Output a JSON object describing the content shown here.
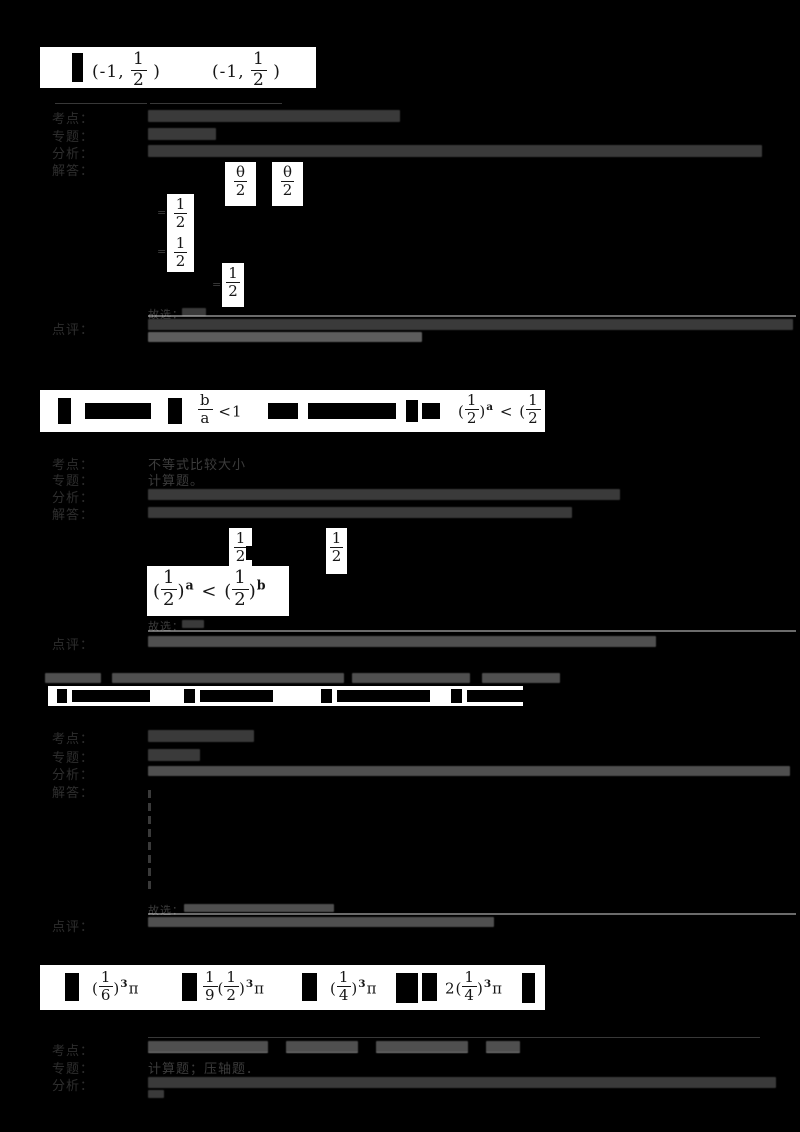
{
  "colors": {
    "page_bg": "#000000",
    "panel_bg": "#ffffff",
    "ink": "#161616",
    "faint_ink": "#3c3c3c",
    "grid_line": "#bababa"
  },
  "row_labels": {
    "kaodian": "考点：",
    "zhuanti": "专题：",
    "fenxi": "分析：",
    "jieda": "解答：",
    "dianping": "点评："
  },
  "q1": {
    "answers": [
      {
        "open": "(-1,",
        "frac": {
          "num": "1",
          "den": "2"
        },
        "close": ")"
      },
      {
        "open": "(-1,",
        "frac": {
          "num": "1",
          "den": "2"
        },
        "close": ")"
      }
    ],
    "solution": {
      "theta_frac_1": {
        "num": "θ",
        "den": "2"
      },
      "theta_comma": ",",
      "theta_frac_2": {
        "num": "θ",
        "den": "2"
      },
      "eq1": "=",
      "half_1": {
        "num": "1",
        "den": "2"
      },
      "eq2": "=",
      "half_2": {
        "num": "1",
        "den": "2"
      },
      "eq3": "=",
      "half_3": {
        "num": "1",
        "den": "2"
      },
      "choose": "故选："
    }
  },
  "q2": {
    "options": {
      "b_frac": {
        "num": "b",
        "den": "a"
      },
      "b_rel": "<1",
      "d_open": "(",
      "d_half": {
        "num": "1",
        "den": "2"
      },
      "d_close": ")",
      "d_exp": "a",
      "d_rel": "<",
      "d_open2": "(",
      "d_half2": {
        "num": "1",
        "den": "2"
      }
    },
    "table": {
      "kaodian_text": "不等式比较大小",
      "zhuanti_text": "计算题。"
    },
    "solution": {
      "half_1": {
        "num": "1",
        "den": "2"
      },
      "half_2": {
        "num": "1",
        "den": "2"
      },
      "formula": {
        "open1": "(",
        "half1": {
          "num": "1",
          "den": "2"
        },
        "close1": ")",
        "exp1": "a",
        "rel": "<",
        "open2": "(",
        "half2": {
          "num": "1",
          "den": "2"
        },
        "close2": ")",
        "exp2": "b"
      },
      "choose": "故选："
    }
  },
  "q3": {
    "solution": {
      "choose": "故选："
    }
  },
  "q4": {
    "options": {
      "a": {
        "open": "(",
        "frac": {
          "num": "1",
          "den": "6"
        },
        "close": ")",
        "exp": "3",
        "pi": "π"
      },
      "b": {
        "coef": {
          "num": "1",
          "den": "9"
        },
        "open": "(",
        "frac": {
          "num": "1",
          "den": "2"
        },
        "close": ")",
        "exp": "3",
        "pi": "π"
      },
      "c": {
        "open": "(",
        "frac": {
          "num": "1",
          "den": "4"
        },
        "close": ")",
        "exp": "3",
        "pi": "π"
      },
      "d": {
        "coef": "2",
        "open": "(",
        "frac": {
          "num": "1",
          "den": "4"
        },
        "close": ")",
        "exp": "3",
        "pi": "π"
      }
    },
    "table": {
      "zhuanti_text": "计算题；压轴题．"
    }
  }
}
